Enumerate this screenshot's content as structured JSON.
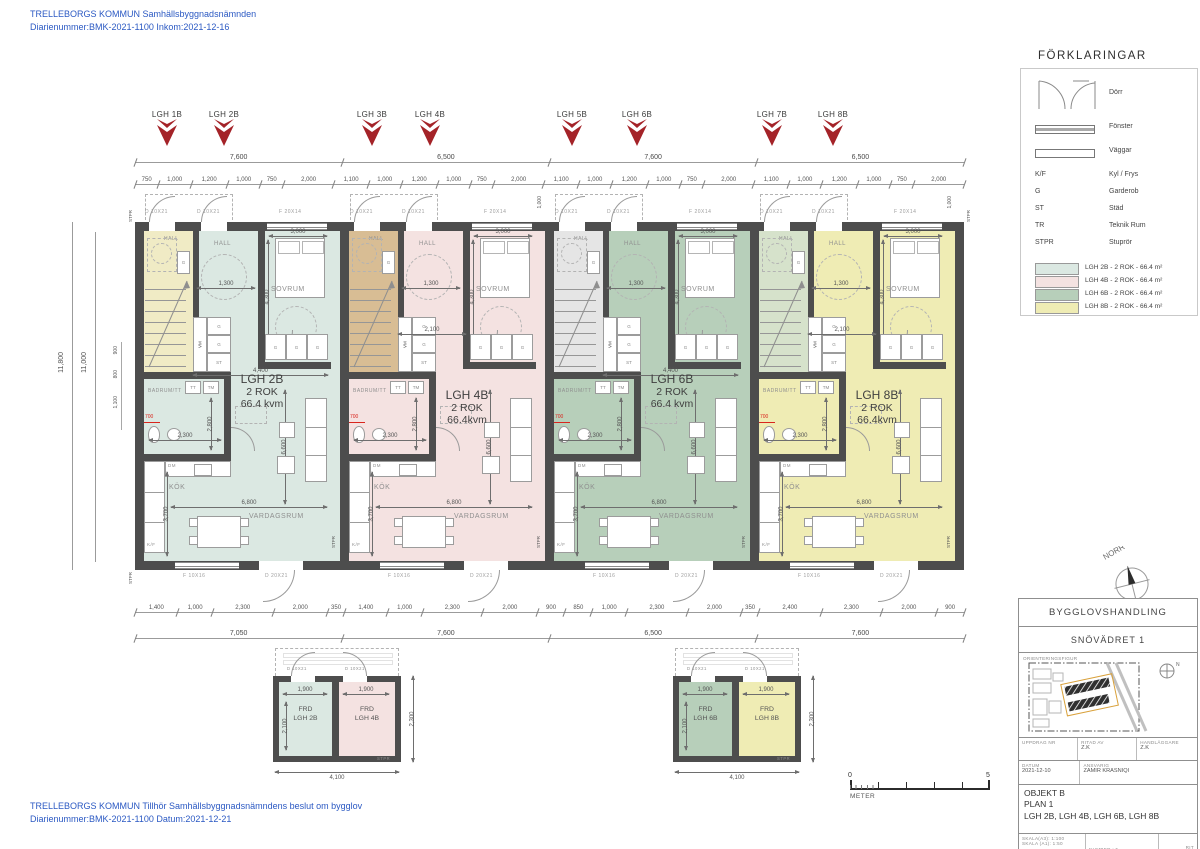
{
  "header": {
    "line1": "TRELLEBORGS KOMMUN Samhällsbyggnadsnämnden",
    "line2": "Diarienummer:BMK-2021-1100 Inkom:2021-12-16"
  },
  "footer": {
    "line1": "TRELLEBORGS KOMMUN Tillhör Samhällsbyggnadsnämndens beslut om bygglov",
    "line2": "Diarienummer:BMK-2021-1100 Datum:2021-12-21"
  },
  "legend": {
    "title": "FÖRKLARINGAR",
    "door_label": "Dörr",
    "window_label": "Fönster",
    "wall_label": "Väggar",
    "abbr": [
      {
        "abbr": "K/F",
        "label": "Kyl / Frys"
      },
      {
        "abbr": "G",
        "label": "Garderob"
      },
      {
        "abbr": "ST",
        "label": "Städ"
      },
      {
        "abbr": "TR",
        "label": "Teknik Rum"
      },
      {
        "abbr": "STPR",
        "label": "Stuprör"
      }
    ],
    "apartments": [
      {
        "label": "LGH 2B - 2 ROK - 66.4 m²",
        "color": "#dbe8e2"
      },
      {
        "label": "LGH 4B - 2 ROK - 66.4 m²",
        "color": "#f4e2e1"
      },
      {
        "label": "LGH 6B - 2 ROK - 66.4 m²",
        "color": "#b7cfba"
      },
      {
        "label": "LGH 8B - 2 ROK - 66.4 m²",
        "color": "#efecb4"
      }
    ]
  },
  "plan": {
    "marker_labels": [
      "LGH 1B",
      "LGH 2B",
      "LGH 3B",
      "LGH 4B",
      "LGH 5B",
      "LGH 6B",
      "LGH 7B",
      "LGH 8B"
    ],
    "top_totals": [
      "7,600",
      "6,500",
      "7,600",
      "6,500"
    ],
    "top_detail": [
      "750",
      "1,000",
      "1,200",
      "1,000",
      "750",
      "2,000",
      "1,100",
      "1,000",
      "1,200",
      "1,000",
      "750",
      "2,000",
      "1,100",
      "1,000",
      "1,200",
      "1,000",
      "750",
      "2,000",
      "1,100",
      "1,000",
      "1,200",
      "1,000",
      "750",
      "2,000"
    ],
    "bottom_detail": [
      "1,400",
      "1,000",
      "2,300",
      "2,000",
      "350",
      "1,400",
      "1,000",
      "2,300",
      "2,000",
      "900",
      "850",
      "1,000",
      "2,300",
      "2,000",
      "350",
      "2,400",
      "2,300",
      "2,000",
      "900"
    ],
    "bottom_totals": [
      "7,050",
      "7,600",
      "6,500",
      "7,600"
    ],
    "left_dims": [
      "11,800",
      "11,000"
    ],
    "left_small": [
      "900",
      "800",
      "1,100"
    ],
    "labels": {
      "hall": "HALL",
      "sovrum": "SOVRUM",
      "badrum": "BADRUM/TT",
      "kok": "KÖK",
      "vardagsrum": "VARDAGSRUM",
      "g": "G",
      "st": "ST",
      "dm": "DM",
      "kf": "K/F",
      "vm": "VM",
      "tt": "TT",
      "tm": "TM",
      "stpr": "STPR"
    },
    "unit_dims": {
      "hall_w": "1,300",
      "sovrum_w": "3,000",
      "sovrum_h": "4,300",
      "bad_w": "2,300",
      "bad_h": "2,800",
      "kok_d": "3,700",
      "vard_w": "6,800",
      "vard_h": "6,600",
      "level": "700",
      "entry_top": "1,000"
    },
    "openings": {
      "door_top": "D 10X21",
      "window_top": "F 20X14",
      "window_bottom": "F 10X16",
      "door_bottom": "D 20X21"
    }
  },
  "units": [
    {
      "name": "LGH 2B",
      "rok": "2 ROK",
      "area": "66.4 kvm",
      "mid": "4,400",
      "fill": "#dbe8e2",
      "stair_fill": "#f0ebc5"
    },
    {
      "name": "LGH 4B",
      "rok": "2 ROK",
      "area": "66.4kvm",
      "mid": "2,100",
      "fill": "#f4e2e1",
      "stair_fill": "#d8bd94"
    },
    {
      "name": "LGH 6B",
      "rok": "2 ROK",
      "area": "66.4 kvm",
      "mid": "4,400",
      "fill": "#b7cfba",
      "stair_fill": "#e5e5e5"
    },
    {
      "name": "LGH 8B",
      "rok": "2 ROK",
      "area": "66.4kvm",
      "mid": "2,100",
      "fill": "#efecb4",
      "stair_fill": "#d6e2cb"
    }
  ],
  "storage": {
    "dims": {
      "room_w": "1,900",
      "room_d": "2,100",
      "side": "2,300",
      "total": "4,100"
    },
    "door": "D 10X21",
    "stpr": "STPR",
    "buildings": [
      {
        "rooms": [
          {
            "line1": "FRD",
            "line2": "LGH 2B",
            "fill": "#dbe8e2"
          },
          {
            "line1": "FRD",
            "line2": "LGH 4B",
            "fill": "#f4e2e1"
          }
        ]
      },
      {
        "rooms": [
          {
            "line1": "FRD",
            "line2": "LGH 6B",
            "fill": "#b7cfba"
          },
          {
            "line1": "FRD",
            "line2": "LGH 8B",
            "fill": "#efecb4"
          }
        ]
      }
    ]
  },
  "scalebar": {
    "zero": "0",
    "five": "5",
    "unit": "METER"
  },
  "north": {
    "label": "NORR"
  },
  "titleblock": {
    "doc_type": "BYGGLOVSHANDLING",
    "property": "SNÖVÄDRET 1",
    "orientation_label": "ORIENTERINGSFIGUR",
    "north_letter": "N",
    "uppdrag_label": "UPPDRAG NR",
    "ritad_label": "RITAD AV",
    "ritad_value": "Z.K",
    "handlaggare_label": "HANDLÄGGARE",
    "handlaggare_value": "Z.K",
    "datum_label": "DATUM",
    "datum_value": "2021-12-10",
    "ansvarig_label": "ANSVARIG",
    "ansvarig_value": "ZAMIR KRASNIQI",
    "object_line1": "OBJEKT B",
    "object_line2": "PLAN 1",
    "object_line3": "LGH 2B, LGH 4B, LGH 6B, LGH 8B",
    "scale_line1": "SKALA(A3): 1:100",
    "scale_line2": "SKALA (A1): 1:50",
    "number": "NUMBER : 5",
    "corner": "RIT"
  }
}
